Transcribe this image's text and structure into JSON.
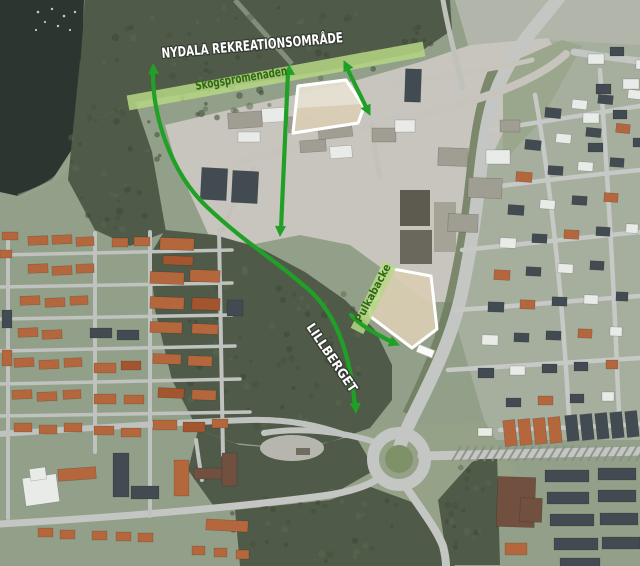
{
  "labels": {
    "recreation_area": "NYDALA REKREATIONSOMRÅDE",
    "promenade": "Skogspromenaden",
    "hill": "LILLBERGET",
    "sled_hill": "Pulkabacke"
  },
  "colors": {
    "arrow_green": "#21a028",
    "band_fill": "#b7d785",
    "band_text": "#2d6a12",
    "site_border": "#ffffff"
  },
  "bands": [
    {
      "name": "promenade-band",
      "x1": 128,
      "y1": 103,
      "x2": 424,
      "y2": 49,
      "width": 15
    },
    {
      "name": "sled-hill-band",
      "x1": 357,
      "y1": 331,
      "x2": 390,
      "y2": 264,
      "width": 14
    }
  ],
  "sites": [
    {
      "name": "north-development-site",
      "points": "298,86 346,80 364,107 358,123 293,133",
      "fill": "#e7e1d3",
      "inner": "297,108 362,104 358,123 293,133",
      "inner_fill": "#d7cbb1"
    },
    {
      "name": "sled-hill-site",
      "points": "388,268 431,276 437,329 412,348 371,317 368,302 378,298 381,270",
      "fill": "#d9cdb3"
    }
  ],
  "arrows": [
    {
      "name": "trail-arrow-west",
      "path": "M153,70 C152,114 170,172 207,207 C243,241 272,258 302,284 C332,307 349,344 355,406",
      "tips": [
        [
          153,
          64,
          -4
        ],
        [
          356,
          413,
          176
        ]
      ]
    },
    {
      "name": "trail-arrow-center",
      "path": "M288,72 L281,229",
      "tips": [
        [
          289,
          65,
          -3
        ],
        [
          280,
          236,
          183
        ]
      ]
    },
    {
      "name": "trail-arrow-east",
      "path": "M347,68 L367,109",
      "tips": [
        [
          344,
          61,
          -26
        ],
        [
          370,
          115,
          154
        ]
      ]
    },
    {
      "name": "sled-access-arrow",
      "path": "M351,315 C360,325 374,333 392,342",
      "tips": [
        [
          399,
          345,
          112
        ]
      ]
    }
  ]
}
